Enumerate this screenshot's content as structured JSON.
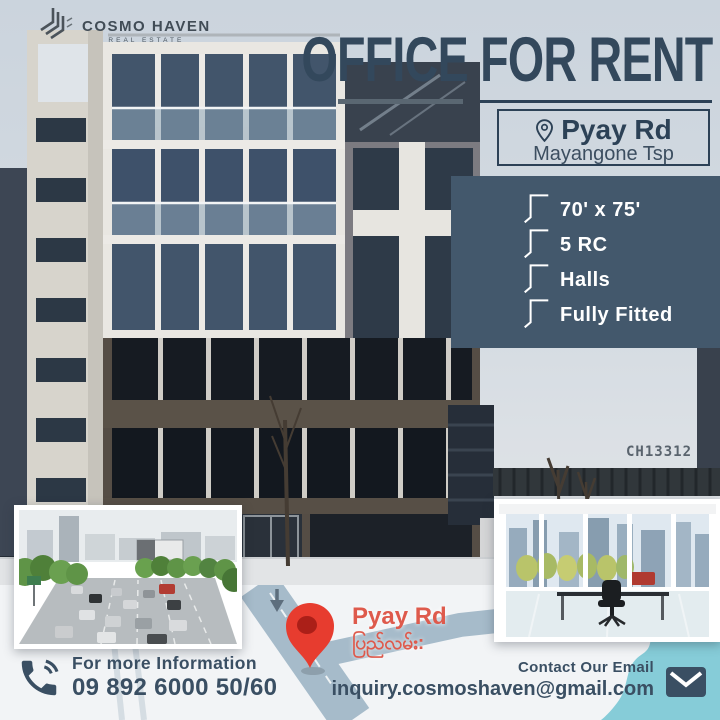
{
  "brand": {
    "name": "COSMO HAVEN",
    "tagline": "REAL ESTATE"
  },
  "title": "OFFICE FOR RENT",
  "location": {
    "road": "Pyay Rd",
    "township": "Mayangone Tsp"
  },
  "features": [
    "70' x 75'",
    "5 RC",
    "Halls",
    "Fully Fitted"
  ],
  "listing_code": "CH13312",
  "map": {
    "road_label": "Pyay Rd",
    "road_label_burmese": "ပြည်လမ်း:"
  },
  "contact": {
    "phone_heading": "For more Information",
    "phone_number": "09 892 6000 50/60",
    "email_heading": "Contact Our Email",
    "email_address": "inquiry.cosmoshaven@gmail.com"
  },
  "colors": {
    "accent_dark": "#33485c",
    "panel_blue": "#43586c",
    "sky": "#ccd4dd",
    "pin_red": "#e73c2f",
    "map_label_red": "#de5a4c",
    "map_road": "#a6bbca",
    "teal": "#86ccd8"
  },
  "icons": {
    "logo": "abstract-building-mark",
    "location_pin": "map-pin-outline",
    "feature_bullet": "corner-bracket-line",
    "map_pin": "red-map-pin",
    "down_arrow": "arrow-down",
    "phone": "phone-handset-with-waves",
    "email": "envelope"
  }
}
